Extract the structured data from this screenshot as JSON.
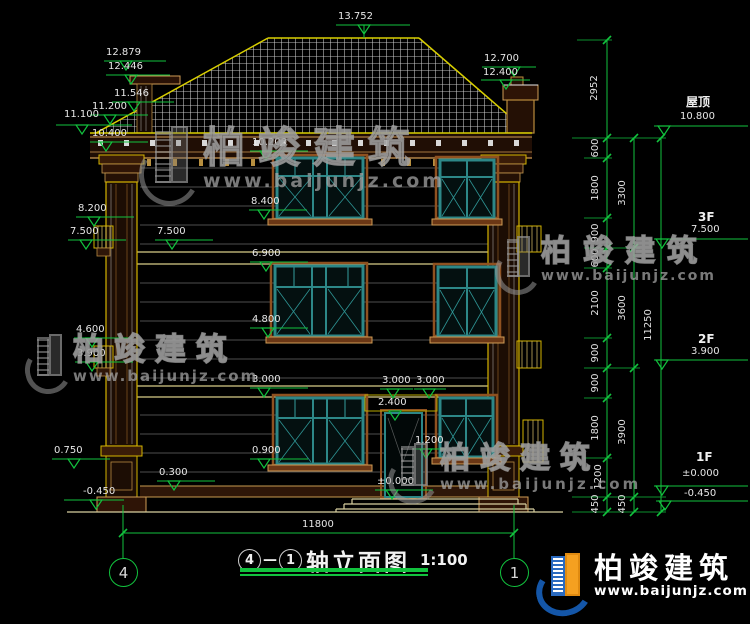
{
  "watermark": {
    "brand": "柏竣建筑",
    "site": "www.baijunjz.com"
  },
  "footer_logo": {
    "brand": "柏竣建筑",
    "site": "www.baijunjz.com"
  },
  "title_bar": {
    "axis_from": "4",
    "separator": "—",
    "axis_to": "1",
    "title": "轴立面图",
    "scale": "1:100"
  },
  "axis_bubbles": {
    "left": "4",
    "right": "1"
  },
  "overall_width": "11800",
  "levels_left": [
    "13.752",
    "12.879",
    "12.446",
    "12.700",
    "12.400",
    "11.546",
    "11.200",
    "11.100",
    "10.400",
    "10.200",
    "8.400",
    "8.200",
    "7.500",
    "7.500",
    "6.900",
    "4.800",
    "4.600",
    "3.900",
    "3.000",
    "3.000",
    "3.000",
    "2.400",
    "1.200",
    "0.900",
    "0.750",
    "0.300",
    "±0.000",
    "-0.450"
  ],
  "levels_right": [
    {
      "floor": "屋顶",
      "value": "10.800"
    },
    {
      "floor": "3F",
      "value": "7.500"
    },
    {
      "floor": "2F",
      "value": "3.900"
    },
    {
      "floor": "1F",
      "value": "±0.000"
    },
    {
      "floor": "",
      "value": "-0.450"
    }
  ],
  "chain_col1": [
    "2952",
    "600",
    "1800",
    "900",
    "600",
    "2100",
    "900",
    "900",
    "1800",
    "1200",
    "450",
    "450"
  ],
  "chain_col2": [
    "3300",
    "3600",
    "3900"
  ],
  "chain_total": "11250",
  "colors": {
    "dimension_green": "#12c23e",
    "roof_yellow": "#d9cf00",
    "window_teal": "#2d8787",
    "trim_brown": "#8f5120",
    "watermark_gray": "#969696"
  }
}
